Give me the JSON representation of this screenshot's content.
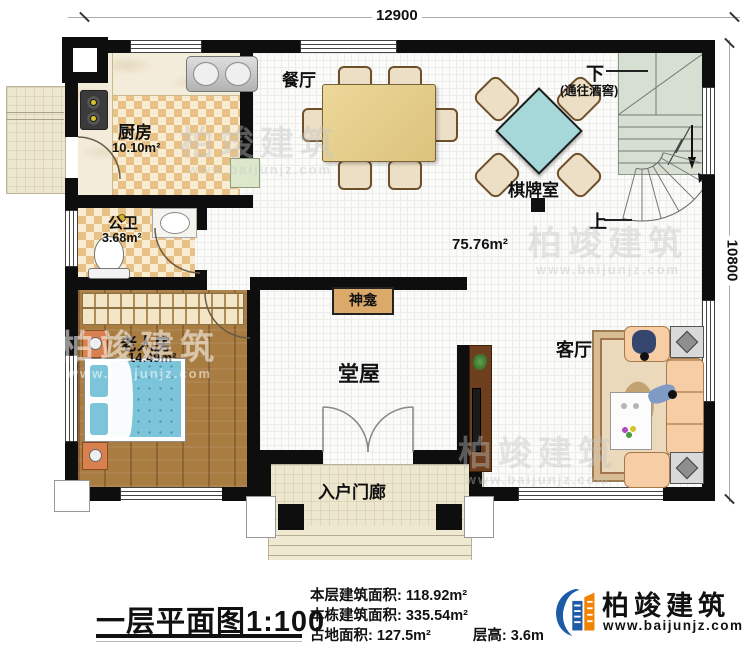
{
  "dimensions": {
    "top": "12900",
    "right": "10800"
  },
  "open_area": "75.76m²",
  "rooms": {
    "kitchen": {
      "label": "厨房",
      "area": "10.10m²"
    },
    "dining": {
      "label": "餐厅"
    },
    "bath": {
      "label": "公卫",
      "area": "3.68m²"
    },
    "elder": {
      "label": "老人房",
      "area": "14.49m²"
    },
    "hall": {
      "label": "堂屋"
    },
    "living": {
      "label": "客厅"
    },
    "chess": {
      "label": "棋牌室"
    },
    "porch": {
      "label": "入户门廊"
    },
    "shrine": {
      "label": "神龛"
    }
  },
  "stairs": {
    "down": "下",
    "down_note": "(通往酒窖)",
    "up": "上"
  },
  "footer": {
    "title": "一层平面图",
    "scale": "1:100",
    "stats": [
      {
        "label": "本层建筑面积:",
        "value": "118.92m²"
      },
      {
        "label": "本栋建筑面积:",
        "value": "335.54m²"
      },
      {
        "label": "占地面积:",
        "value": "127.5m²"
      },
      {
        "label": "层高:",
        "value": "3.6m"
      }
    ]
  },
  "brand": {
    "name": "柏竣建筑",
    "website": "www.baijunjz.com"
  },
  "watermark": {
    "name": "柏竣建筑",
    "website": "www.baijunjz.com"
  },
  "colors": {
    "wall": "#0e0e0e",
    "checker": "#e7c186",
    "wood": "#a97c42",
    "bed": "#7cc4d9",
    "mahjong_table": "#a6d8da",
    "sofa": "#f6cda5",
    "stair": "#d6dfd2",
    "brand_blue": "#1d5ba6",
    "brand_orange": "#f08300"
  }
}
